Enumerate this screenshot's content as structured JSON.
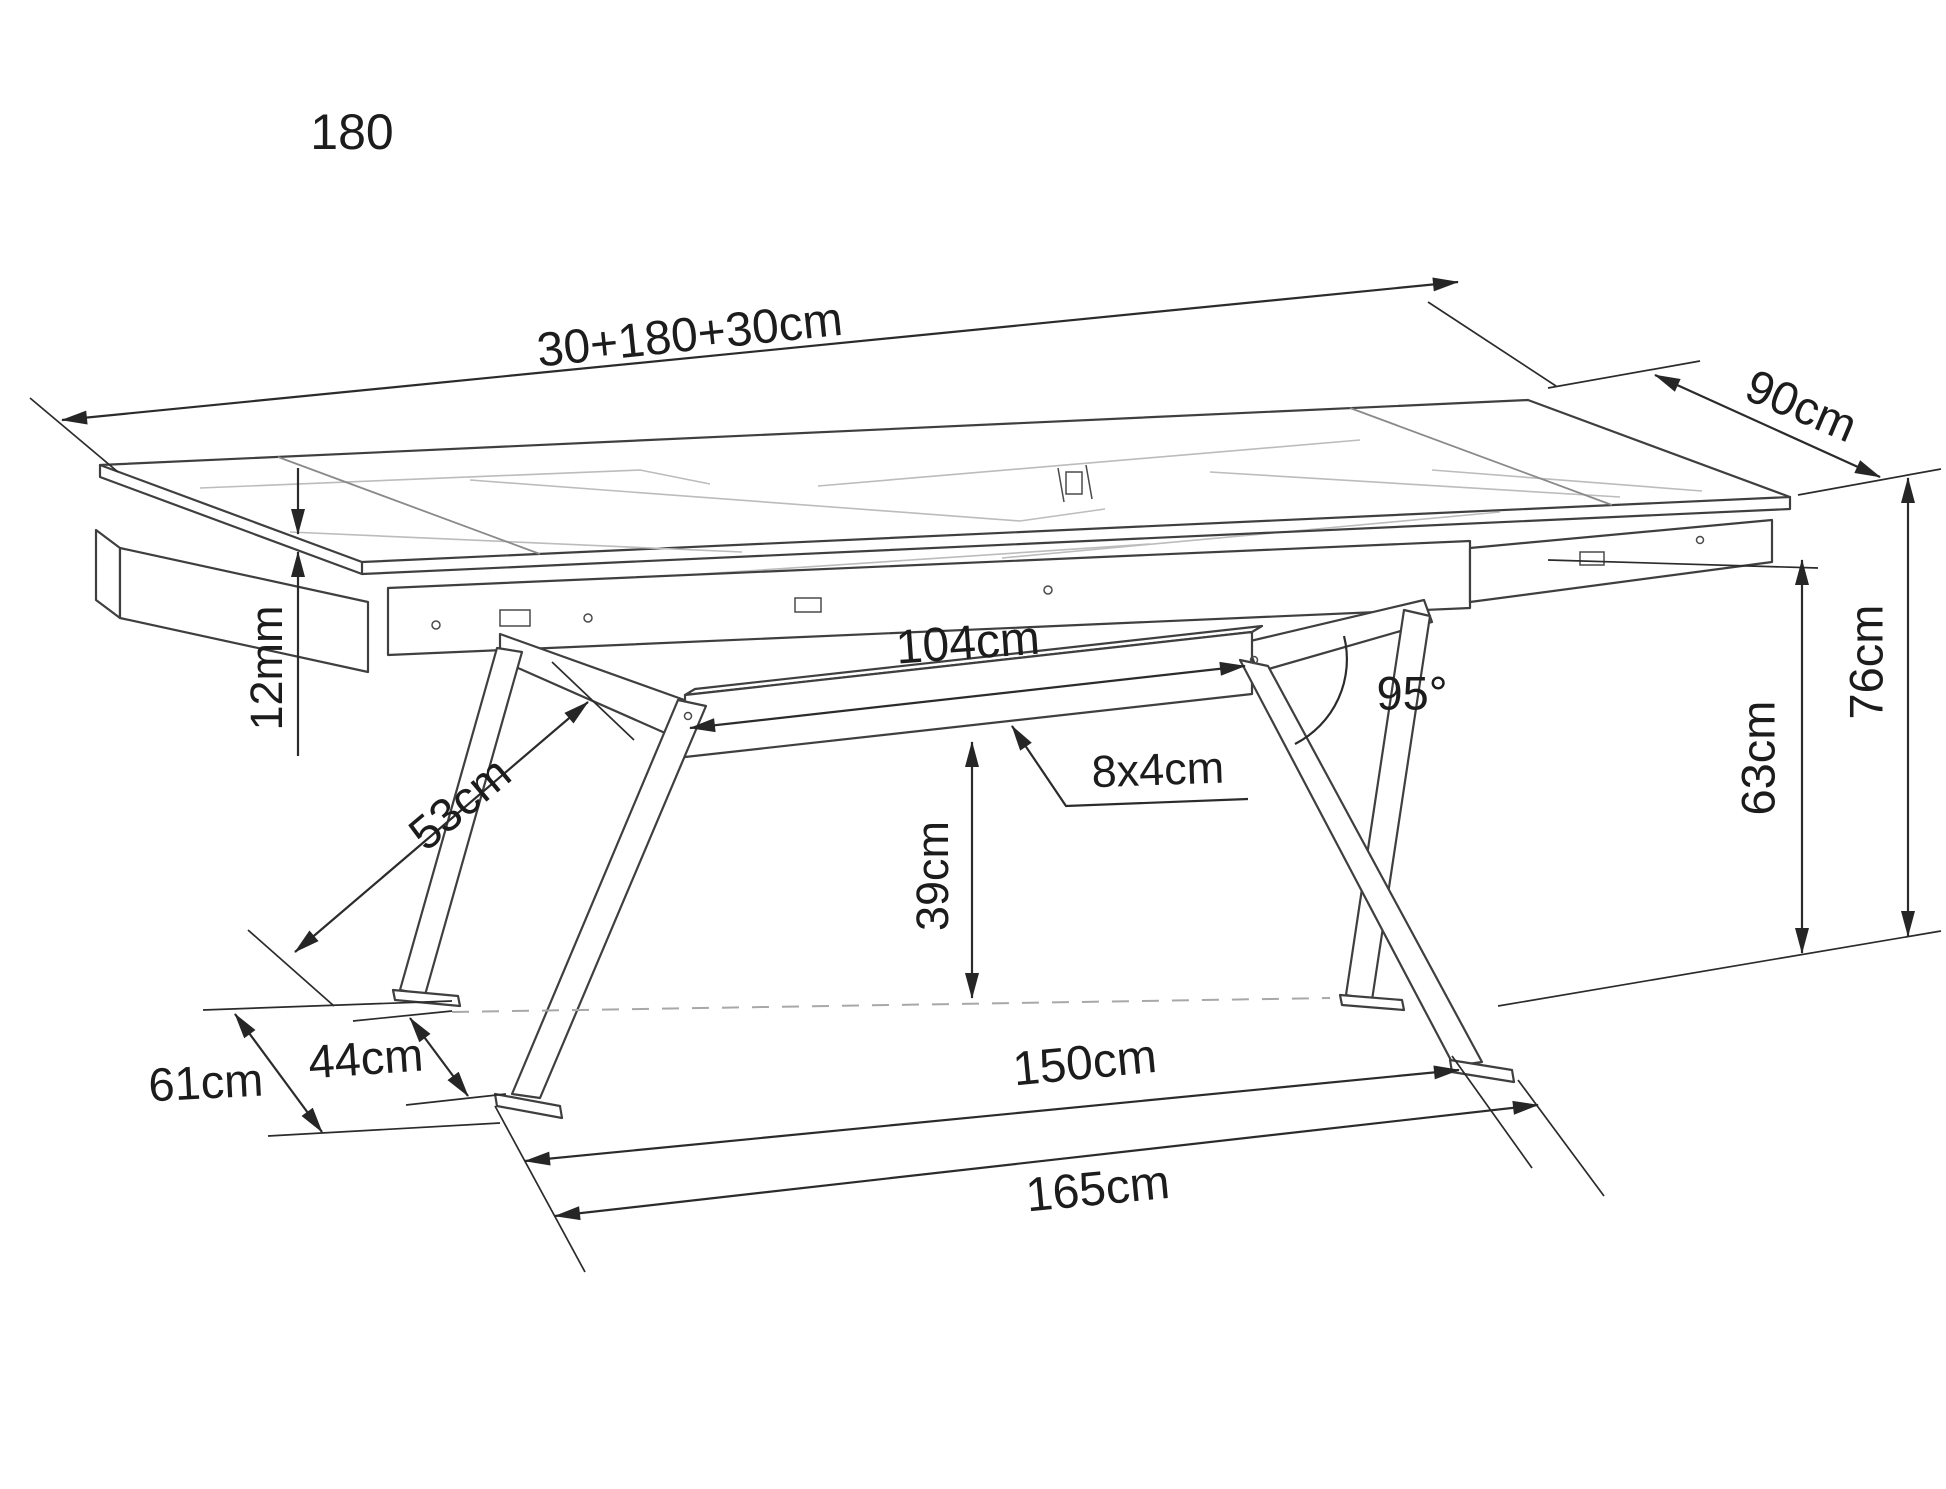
{
  "page": {
    "background": "#ffffff"
  },
  "drawing": {
    "type": "technical-dimension-drawing",
    "subject": "extendable dining table with spider legs",
    "size_label": "180",
    "labels": {
      "top_length": "30+180+30cm",
      "depth": "90cm",
      "top_thickness": "12mm",
      "arm_length": "53cm",
      "beam_length": "104cm",
      "beam_profile": "8x4cm",
      "leg_angle": "95°",
      "beam_floor_clearance": "39cm",
      "apron_height": "63cm",
      "total_height": "76cm",
      "base_depth": "61cm",
      "feet_gap": "44cm",
      "feet_span_inner": "150cm",
      "feet_span_outer": "165cm"
    },
    "colors": {
      "line": "#3f3f3f",
      "dimension": "#2b2b2b",
      "vein": "#bcbcbc",
      "dashed_floor": "#a8a8a8",
      "background": "#ffffff"
    }
  }
}
